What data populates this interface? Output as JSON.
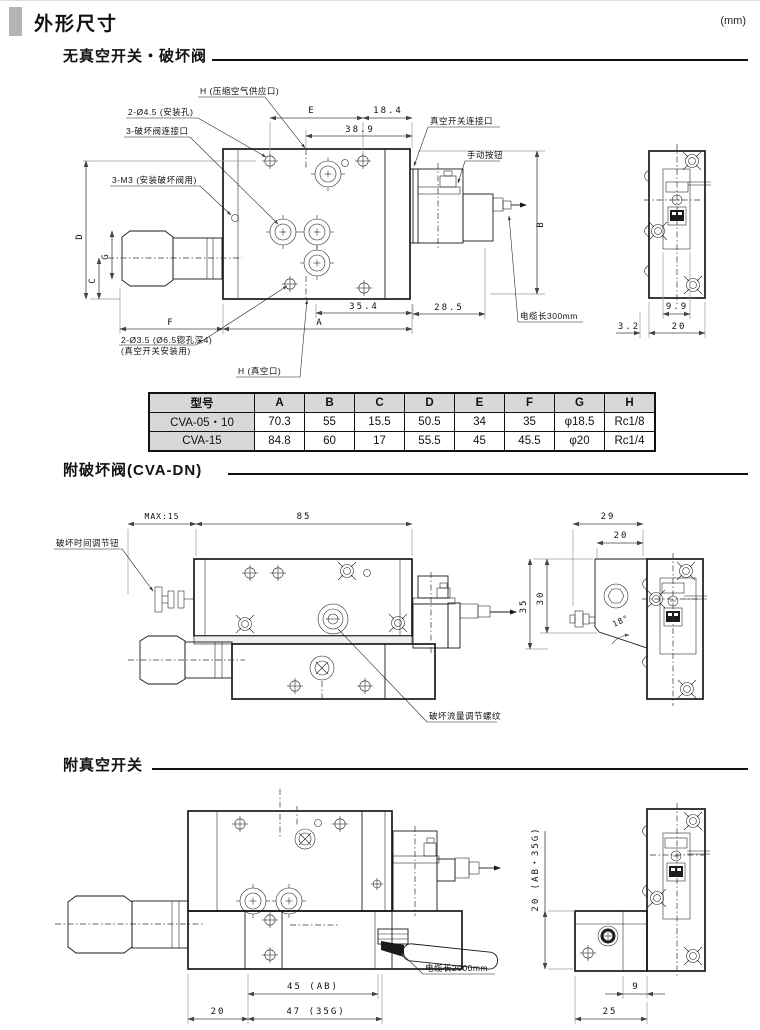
{
  "header": {
    "title": "外形尺寸",
    "unit": "(mm)"
  },
  "s1": {
    "title": "无真空开关・破坏阀",
    "callouts": {
      "air": "H (压缩空气供应口)",
      "mount": "2-Ø4.5 (安装孔)",
      "valve": "3-破坏阀连接口",
      "m3": "3-M3 (安装破坏阀用)",
      "vsw": "真空开关连接口",
      "manual": "手动按钮",
      "cable": "电缆长300mm",
      "cb1": "2-Ø3.5 (Ø6.5锪孔深4)",
      "cb2": "(真空开关安装用)",
      "vac": "H (真空口)"
    },
    "dims": {
      "E": "E",
      "d184": "18.4",
      "d389": "38.9",
      "B": "B",
      "D": "D",
      "G": "G",
      "C": "C",
      "F": "F",
      "A": "A",
      "d354": "35.4",
      "d285": "28.5",
      "d99": "9.9",
      "d32": "3.2",
      "d20": "20"
    }
  },
  "table": {
    "headers": [
      "型号",
      "A",
      "B",
      "C",
      "D",
      "E",
      "F",
      "G",
      "H"
    ],
    "rows": [
      [
        "CVA-05・10",
        "70.3",
        "55",
        "15.5",
        "50.5",
        "34",
        "35",
        "φ18.5",
        "Rc1/8"
      ],
      [
        "CVA-15",
        "84.8",
        "60",
        "17",
        "55.5",
        "45",
        "45.5",
        "φ20",
        "Rc1/4"
      ]
    ]
  },
  "s2": {
    "title": "附破坏阀(CVA-DN)",
    "callouts": {
      "knob": "破坏时间调节钮",
      "screw": "破坏流量调节螺纹"
    },
    "dims": {
      "max": "MAX:15",
      "d85": "85",
      "d29": "29",
      "d20": "20",
      "d35": "35",
      "d30": "30",
      "ang": "18°"
    }
  },
  "s3": {
    "title": "附真空开关",
    "callouts": {
      "cable": "电缆长2000mm"
    },
    "dims": {
      "d20": "20",
      "d45": "45 (AB)",
      "d47": "47 (35G)",
      "d20ab": "20 (AB・35G)",
      "d9": "9",
      "d25": "25"
    }
  }
}
